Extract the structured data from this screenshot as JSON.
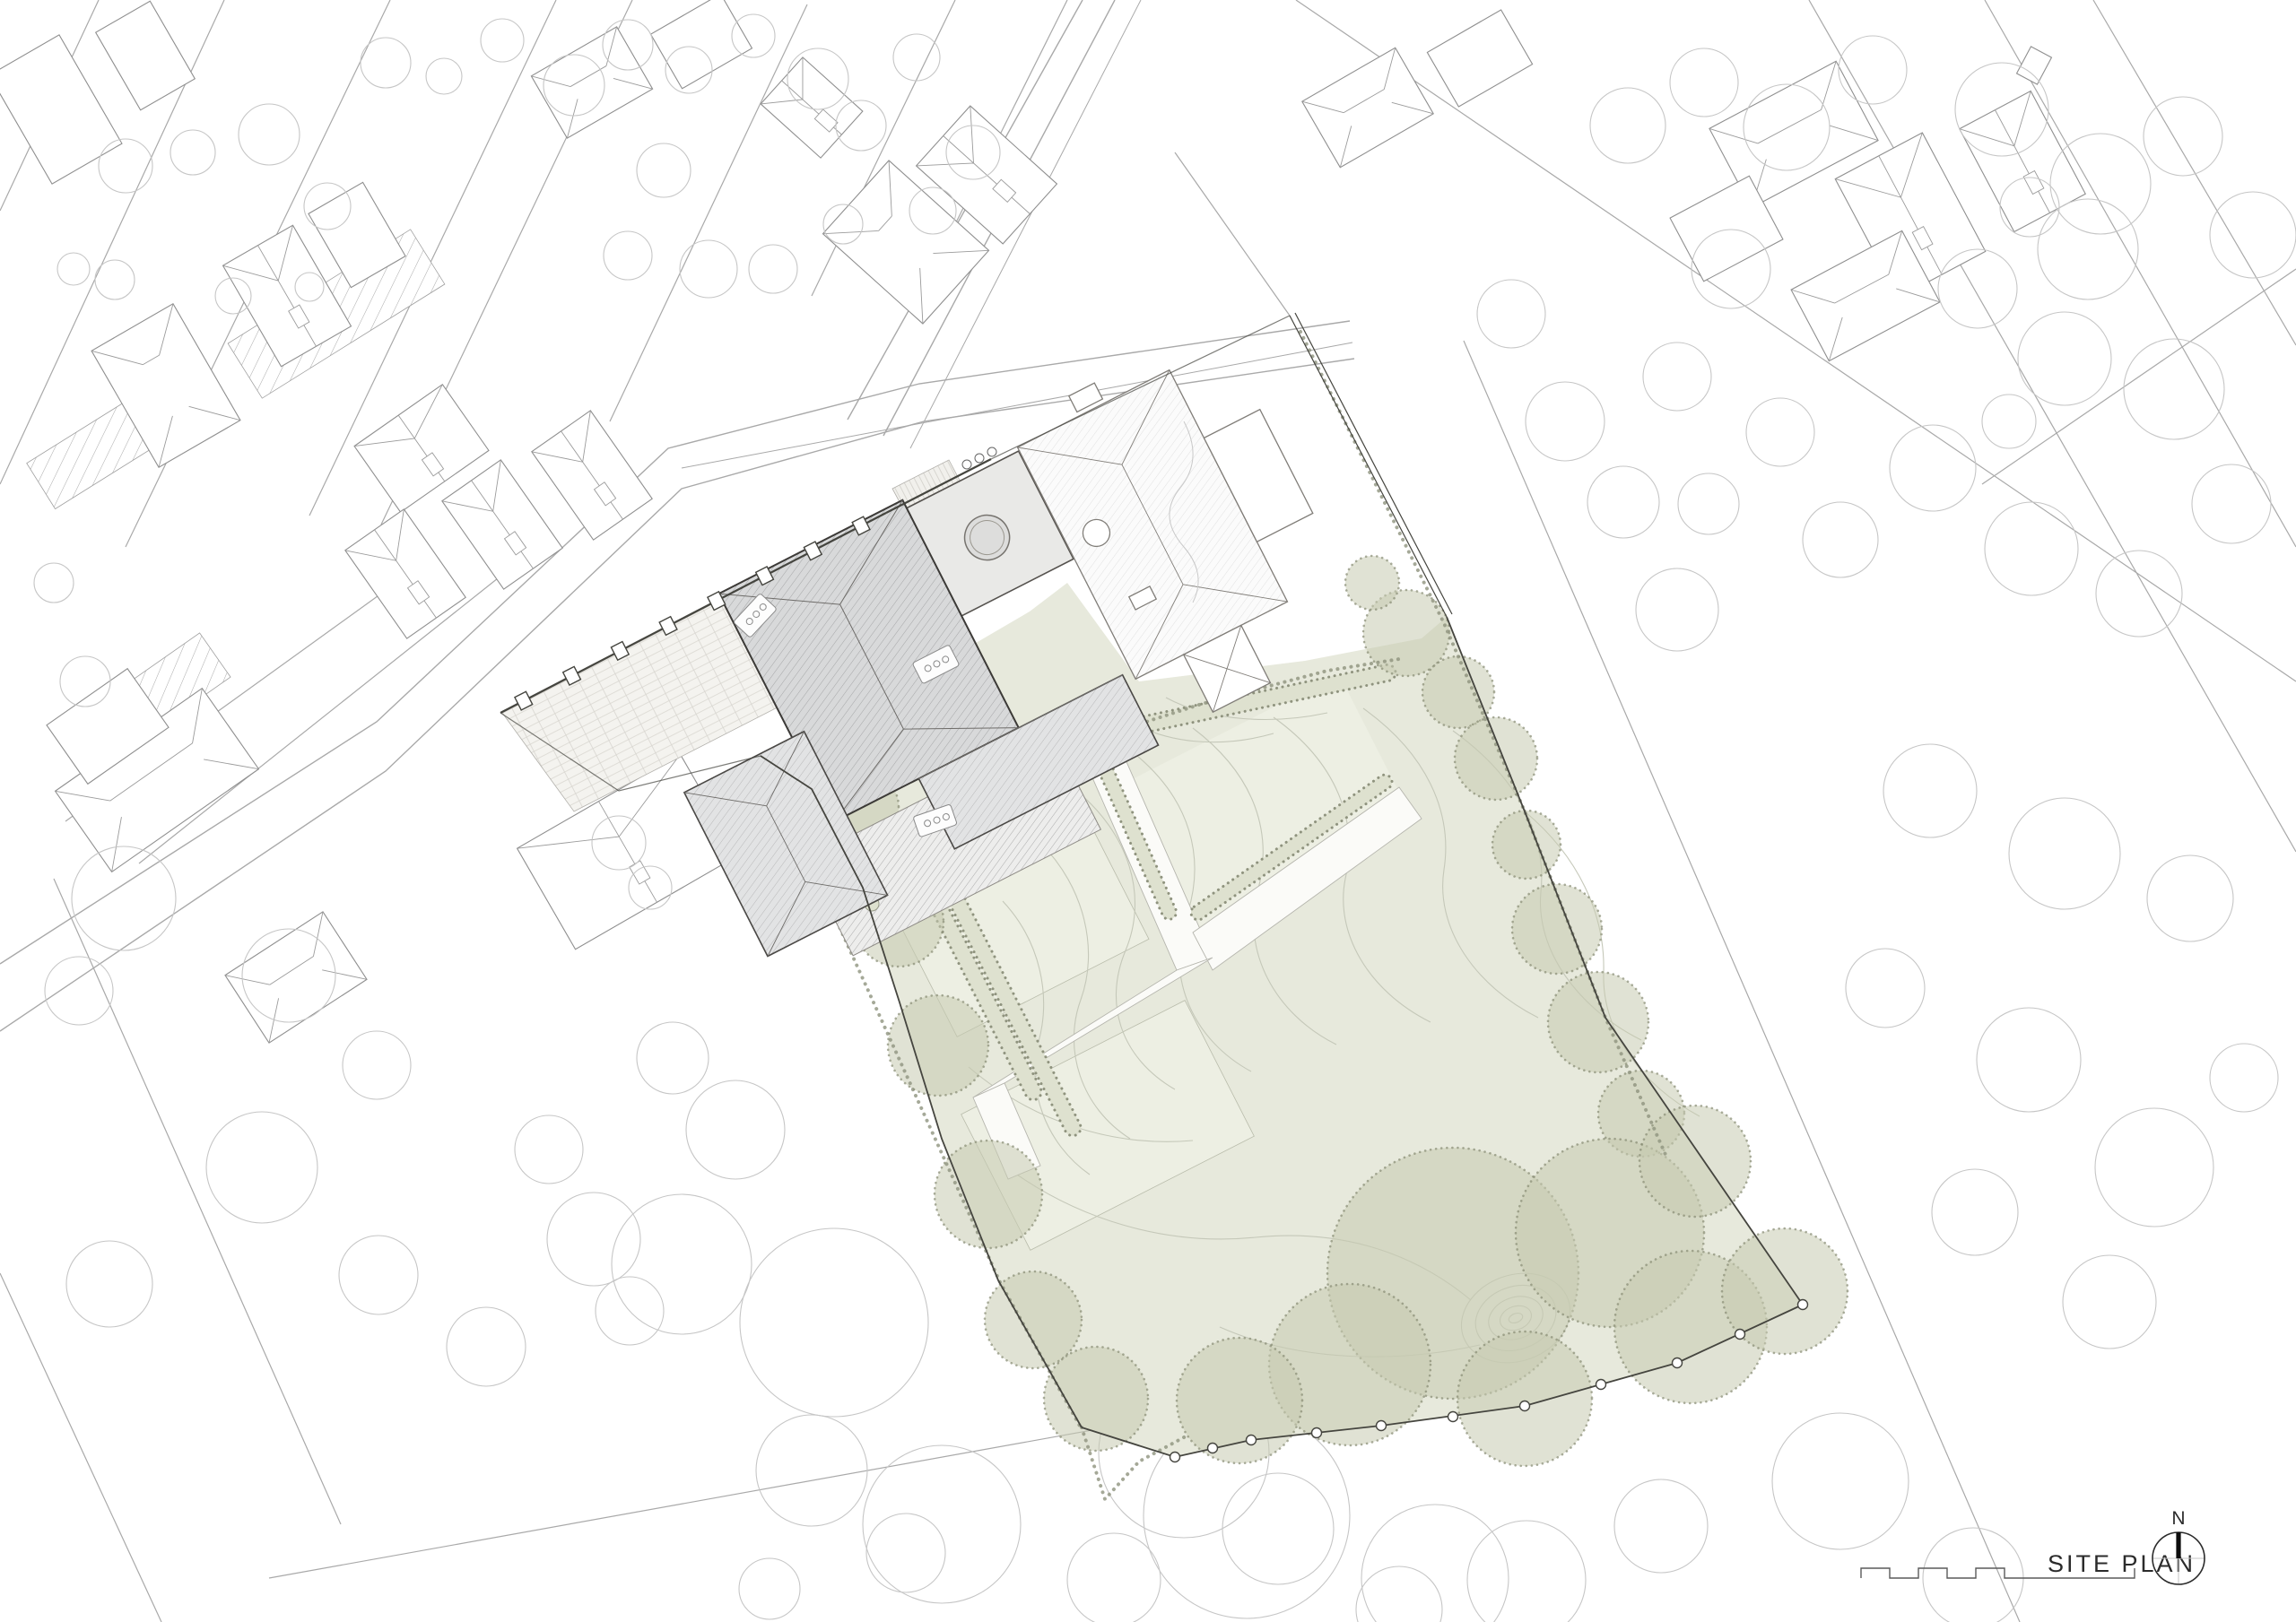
{
  "titleBlock": {
    "title": "SITE PLAN",
    "north_label": "N",
    "north_icon": "north-arrow-icon",
    "scale_icon": "graphic-scale-bar"
  },
  "drawing": {
    "kind": "architectural site plan",
    "site_features": {
      "main_building_roof": "grey hatched hipped roof",
      "garden": "large sage-green lawn with contour lines, gravel paths, planting borders and tree canopies",
      "boundary": "dark site boundary line with fence posts"
    }
  },
  "colors": {
    "lawn": "#e7e9dc",
    "lawn_light": "#edefe3",
    "canopy": "#c7cab1",
    "canopy_edge": "#878b74",
    "contour": "#c5c8b9",
    "roof_main": "#d8d9da",
    "roof_hatch": "#9fa0a1",
    "roof_light_hatch": "#dbdbdb",
    "paving": "#f4f3ef",
    "paving_line": "#d8d6d0",
    "deck": "#ededec",
    "deck_line": "#9a9a9a",
    "boundary": "#45453f",
    "context_line": "#a9a9a9",
    "tree_line": "#c6c6c6",
    "path_fill": "#fbfbf8",
    "planting": "#dee1cf",
    "planting_edge": "#8f937e",
    "text": "#2b2b2b"
  }
}
